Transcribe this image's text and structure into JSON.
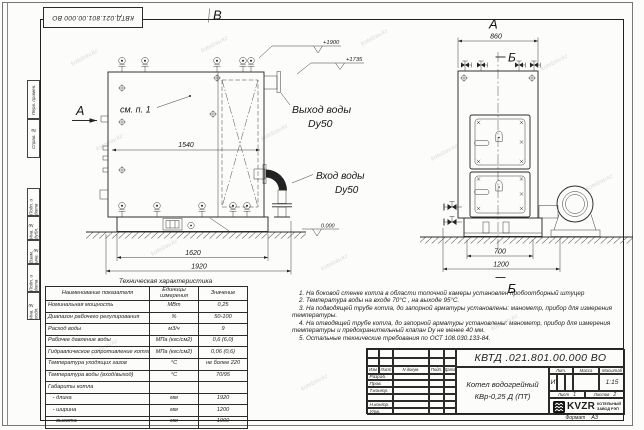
{
  "watermark": "kotelzav.kz",
  "frame": {
    "stamp_doc_number": "КВТД.021.801.00.000 ВО",
    "side_fields": [
      "Перв. примен.",
      "Справ. №",
      "Подп. и дата",
      "Инв. № дубл.",
      "Взам. инв. №",
      "Подп. и дата",
      "Инв. № подл."
    ],
    "format_label": "Формат",
    "format_value": "А3"
  },
  "views": {
    "side": {
      "label": "В",
      "arrow_label": "А",
      "see_note": "см. п. 1",
      "dim_inner": "1540",
      "dim_mid": "1620",
      "dim_outer": "1920",
      "elev_top": "+1900",
      "elev_outlet": "+1735",
      "elev_zero": "0.000",
      "outlet_line1": "Выход воды",
      "outlet_line2": "Dy50",
      "inlet_line1": "Вход воды",
      "inlet_line2": "Dy50"
    },
    "front": {
      "label": "А",
      "dim_top": "860",
      "section_top": "Б",
      "section_bottom": "Б",
      "dim_inner": "700",
      "dim_outer": "1200"
    }
  },
  "spec_table": {
    "title": "Техническая характеристика",
    "headers": [
      "Наименование показателя",
      "Единицы измерения",
      "Значение"
    ],
    "rows": [
      [
        "Номинальная мощность",
        "МВт",
        "0,25"
      ],
      [
        "Диапазон рабочего регулирования",
        "%",
        "50-100"
      ],
      [
        "Расход воды",
        "м3/ч",
        "9"
      ],
      [
        "Рабочее давление воды",
        "МПа (кгс/см2)",
        "0,6 (6,0)"
      ],
      [
        "Гидравлическое сопротивление котла",
        "МПа (кгс/см2)",
        "0,06 (0,6)"
      ],
      [
        "Температура уходящих газов",
        "°С",
        "не более 220"
      ],
      [
        "Температура воды (вход/выход)",
        "°С",
        "70/95"
      ],
      [
        "Габариты котла",
        "",
        ""
      ],
      [
        "   - длина",
        "мм",
        "1920"
      ],
      [
        "   - ширина",
        "мм",
        "1200"
      ],
      [
        "   - высота",
        "мм",
        "1900"
      ]
    ]
  },
  "notes": [
    "1.  На боковой стенке котла в области топочной камеры установлен пробоотборный штуцер",
    "2.  Температура воды на входе 70°С , на выходе 95°С.",
    "3.  На подводящей трубе котла, до запорной арматуры установлены: манометр, прибор для измерения температуры.",
    "4.  На отводящей трубе котла, до запорной арматуры установлены: манометр, прибор для измерения температуры и предохранительный клапан Dу не менее 40 мм.",
    "5.  Остальные технические требования по ОСТ 108.030.133-84."
  ],
  "title_block": {
    "doc_number": "КВТД .021.801.00.000  ВО",
    "rev_headers": [
      "Изм",
      "Лист",
      "N докум.",
      "Подп.",
      "Дата"
    ],
    "sign_labels": [
      "Разраб.",
      "Пров.",
      "Т.контр.",
      "",
      "Н.контр.",
      "Утв."
    ],
    "product_line1": "Котел водогрейный",
    "product_line2": "КВр-0,25  Д  (ПТ)",
    "lit_label": "Лит.",
    "lit_value": "И",
    "mass_label": "Масса",
    "scale_label": "Масштаб",
    "scale_value": "1:15",
    "sheet_label": "Лист",
    "sheet_number": "1",
    "sheets_label": "Листов",
    "sheets_total": "2",
    "logo_text": "KVZR",
    "logo_caption1": "КОТЕЛЬНЫЙ",
    "logo_caption2": "ЗАВОД РЭП"
  }
}
